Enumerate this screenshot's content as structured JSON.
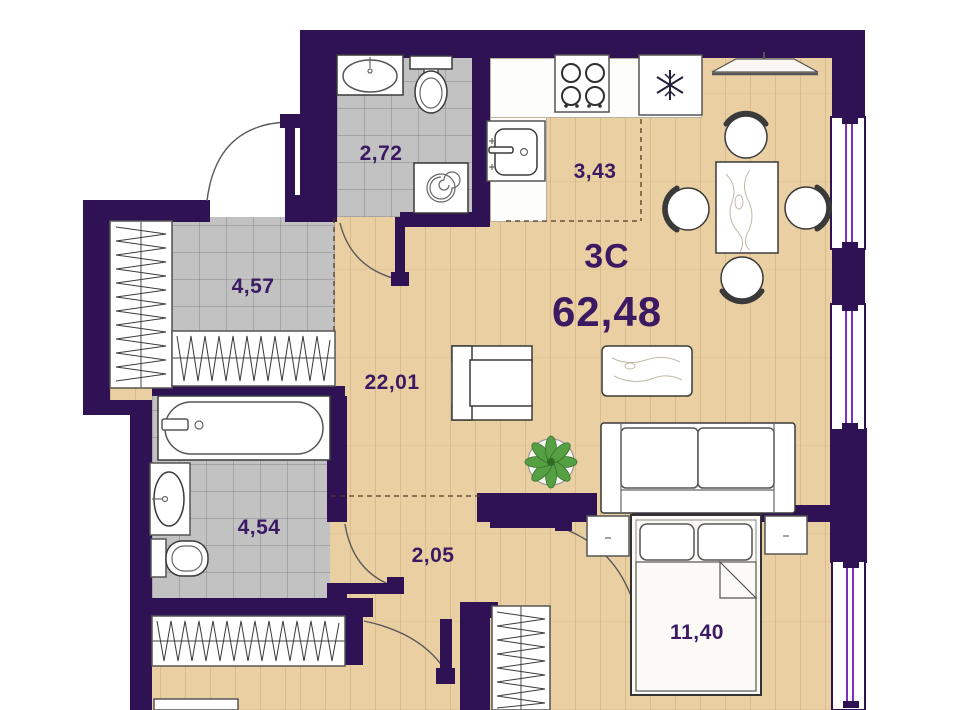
{
  "plan": {
    "type_label": "3C",
    "total_area": "62,48",
    "rooms": {
      "bathroom_top": "2,72",
      "kitchen": "3,43",
      "hallway": "4,57",
      "living": "22,01",
      "bathroom_left": "4,54",
      "corridor": "2,05",
      "bedroom": "11,40"
    },
    "colors": {
      "wall": "#2e1254",
      "wood": "#e9cfa2",
      "tile": "#c2c2c2",
      "label": "#3b1a63",
      "window": "#7d2fc0",
      "plant": "#55a043",
      "outline": "#3a3a3a"
    }
  }
}
